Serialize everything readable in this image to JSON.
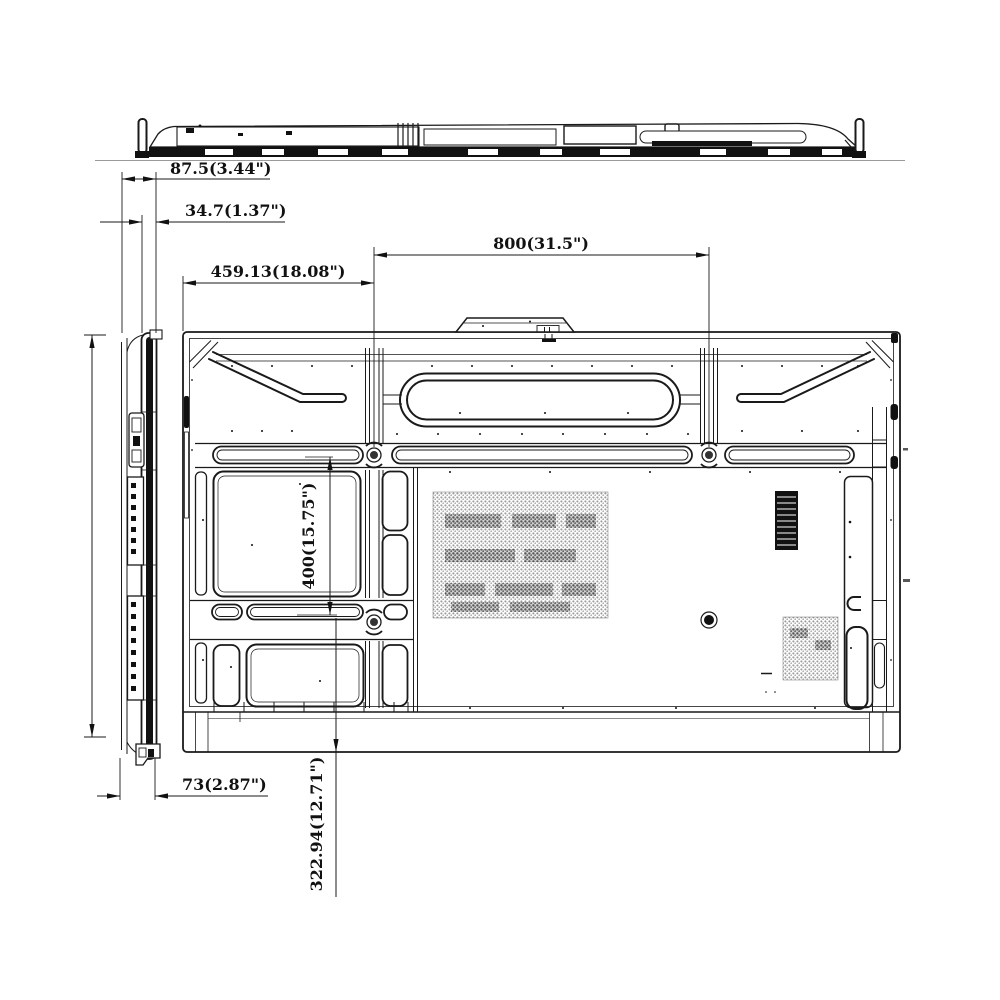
{
  "dims": {
    "overall_depth": "87.5(3.44\")",
    "panel_depth": "34.7(1.37\")",
    "vesa_horizontal": "800(31.5\")",
    "edge_to_vesa": "459.13(18.08\")",
    "vesa_vertical": "400(15.75\")",
    "mount_depth": "73(2.87\")",
    "vesa_to_bottom": "322.94(12.71\")"
  },
  "colors": {
    "line": "#1a1a1a",
    "background": "#ffffff",
    "vent_fill": "#8a8a8a",
    "dark_fill": "#111111"
  }
}
